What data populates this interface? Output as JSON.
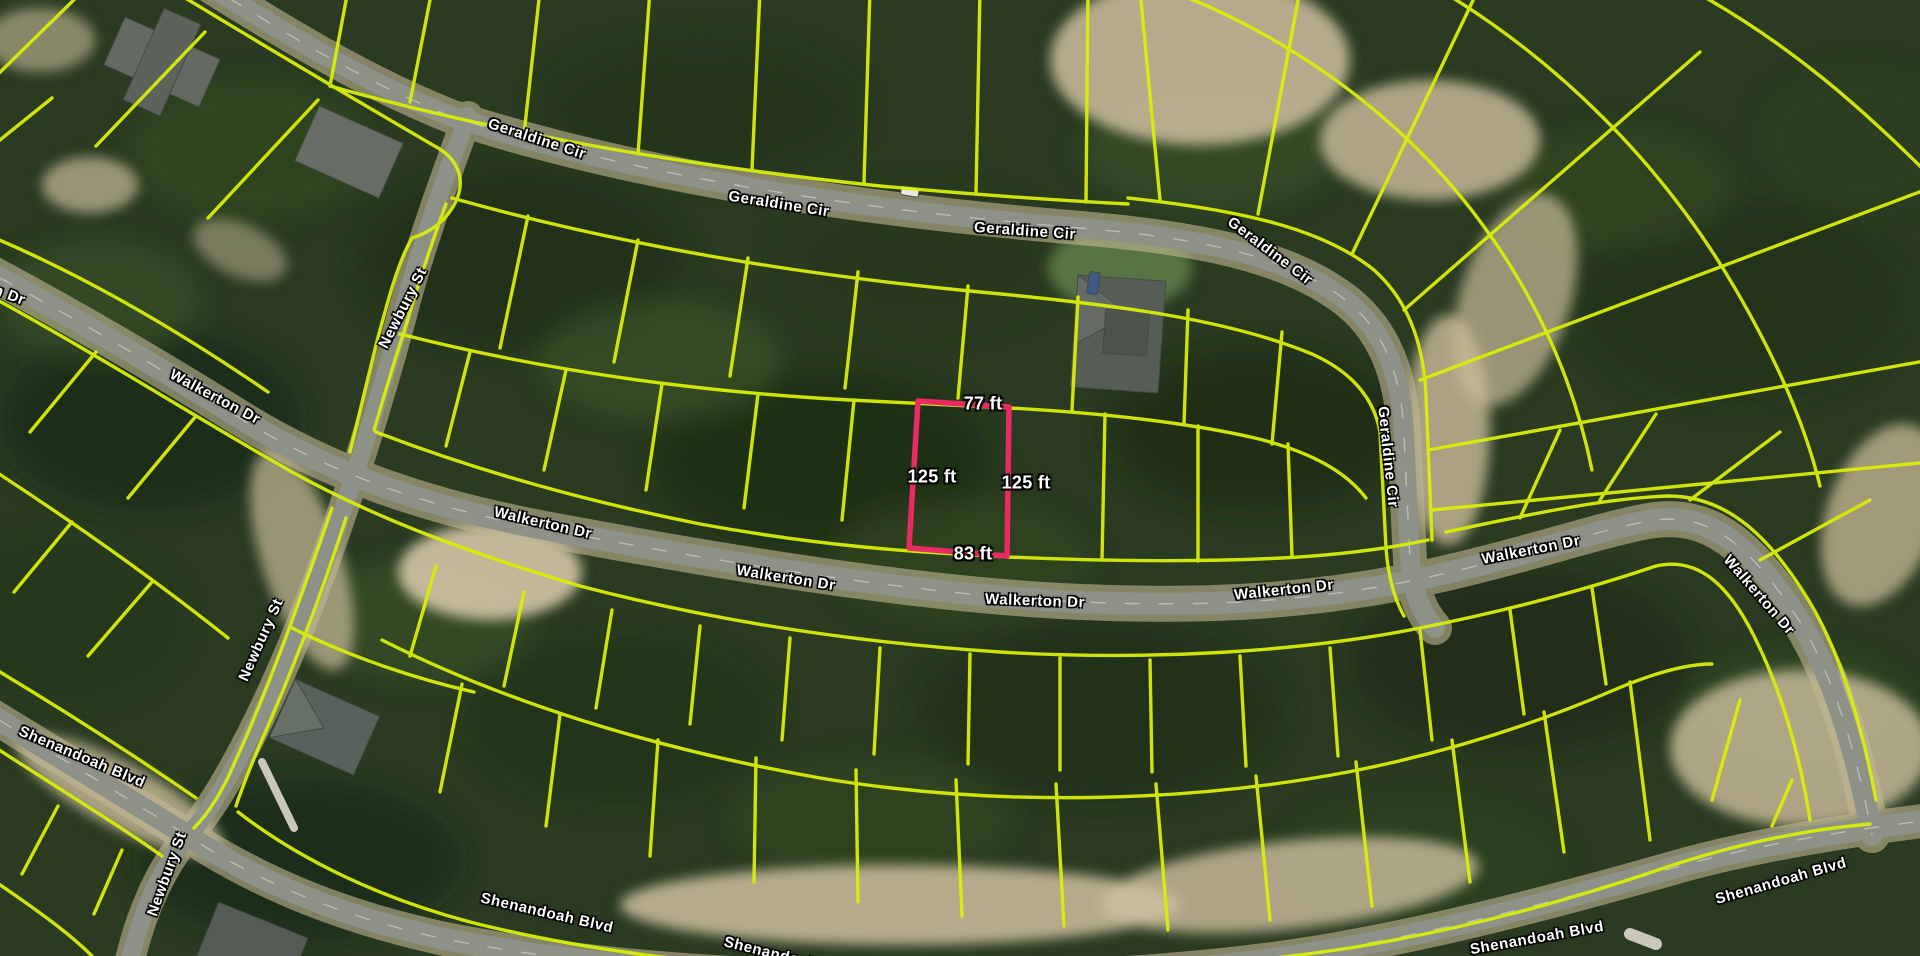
{
  "map": {
    "kind": "aerial-parcel-map",
    "colors": {
      "parcel_line": "#d8ee08",
      "highlight_parcel": "#ea2a62",
      "road": "#8d9187",
      "label_text": "#ffffff",
      "label_outline": "#000000",
      "forest": "#2a3b21",
      "sand": "#cdbf9f"
    },
    "street_labels": [
      {
        "text": "Geraldine Cir"
      },
      {
        "text": "Geraldine Cir"
      },
      {
        "text": "Geraldine Cir"
      },
      {
        "text": "Geraldine Cir"
      },
      {
        "text": "Geraldine Cir"
      },
      {
        "text": "Walkerton Dr"
      },
      {
        "text": "Walkerton Dr"
      },
      {
        "text": "Newbury St"
      },
      {
        "text": "Walkerton Dr"
      },
      {
        "text": "Walkerton Dr"
      },
      {
        "text": "Walkerton Dr"
      },
      {
        "text": "Walkerton Dr"
      },
      {
        "text": "Walkerton Dr"
      },
      {
        "text": "Walkerton Dr"
      },
      {
        "text": "Newbury St"
      },
      {
        "text": "Newbury St"
      },
      {
        "text": "Shenandoah Blvd"
      },
      {
        "text": "Shenandoah Blvd"
      },
      {
        "text": "Shenandoah Blvd"
      },
      {
        "text": "Shenandoah Blvd"
      },
      {
        "text": "Shenandoah Blvd"
      }
    ],
    "highlighted_parcel": {
      "width_top": "77 ft",
      "depth_left": "125 ft",
      "depth_right": "125 ft",
      "width_bottom": "83 ft"
    }
  }
}
